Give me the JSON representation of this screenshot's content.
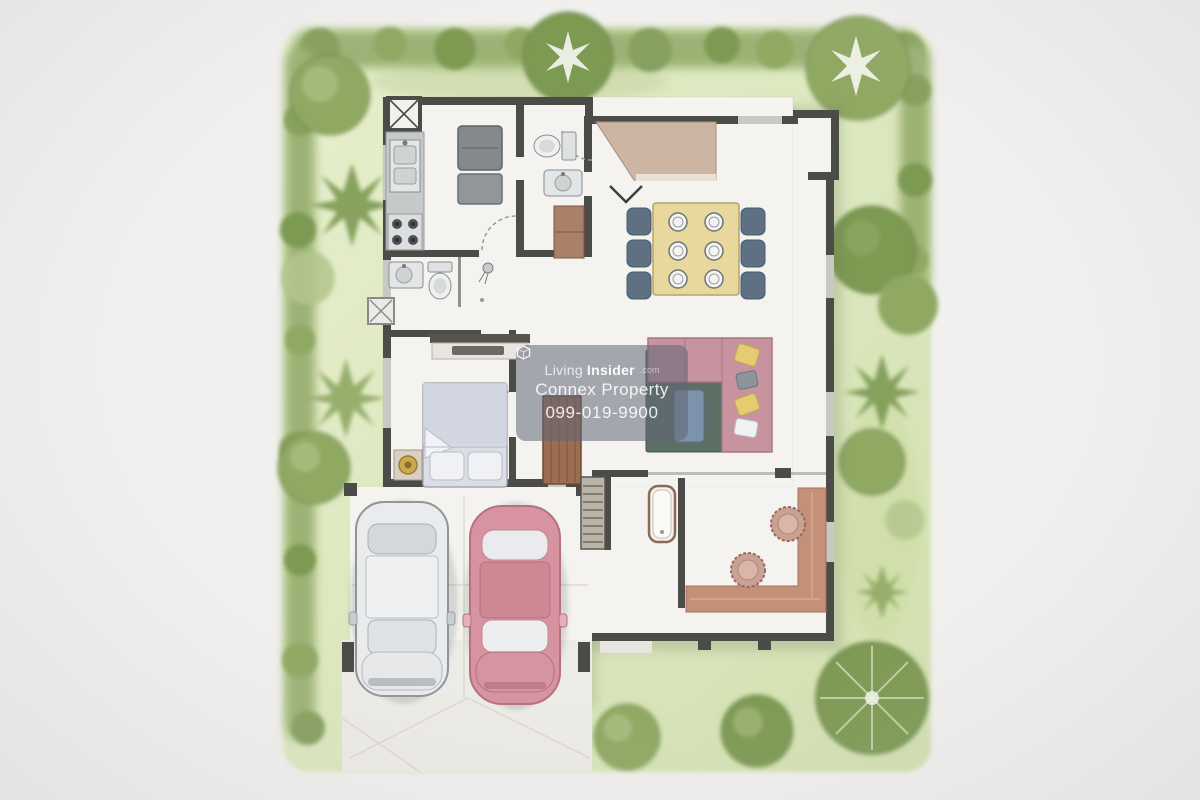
{
  "watermark": {
    "brand_light": "Living",
    "brand_bold": "Insider",
    "brand_suffix": ".com",
    "company": "Connex Property",
    "phone": "099-019-9900"
  },
  "palette": {
    "paper": "#f1f0ee",
    "lawn_light": "#e7efcd",
    "lawn_dark": "#d2e0b0",
    "hedge": "#9cb274",
    "tree_mid": "#8fa963",
    "tree_dark": "#7d9a53",
    "tree_light": "#b3c68c",
    "wall": "#4b4b47",
    "window": "#c9c9c4",
    "floor": "#f4f3ef",
    "table_yellow": "#e9d89e",
    "chair_slate": "#5e7082",
    "sofa_pink": "#c6939f",
    "rug_green": "#5c6f64",
    "terracotta": "#c49078",
    "wood_brown": "#9c6e50",
    "car_red": "#d793a0",
    "car_white": "#e9ebed",
    "wm_bg": "rgba(96,102,118,0.55)",
    "wm_text": "#f4f5f7"
  }
}
